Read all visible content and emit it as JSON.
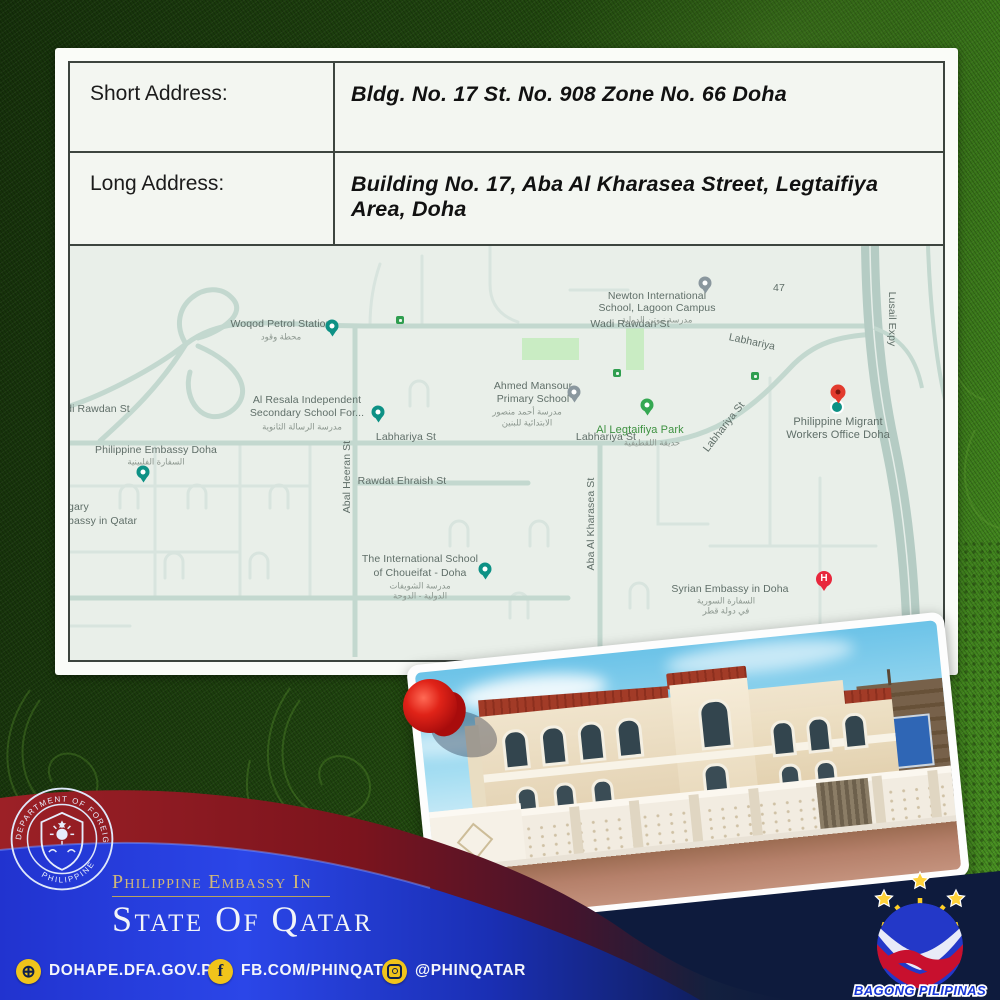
{
  "address_card": {
    "rows": [
      {
        "label": "Short Address:",
        "value": "Bldg. No. 17 St. No. 908 Zone No. 66 Doha"
      },
      {
        "label": "Long Address:",
        "value": "Building No. 17, Aba Al Kharasea Street, Legtaifiya Area, Doha"
      }
    ]
  },
  "map": {
    "h_pin_label": "H",
    "labels": [
      {
        "text": "Woqod Petrol Station"
      },
      {
        "text": "محطة وقود"
      },
      {
        "text": "Wadi Rawdan St"
      },
      {
        "text": "Newton International"
      },
      {
        "text": "School, Lagoon Campus"
      },
      {
        "text": "مدرسة نيوتن الدولية"
      },
      {
        "text": "47"
      },
      {
        "text": "Labhariya"
      },
      {
        "text": "Lusail Expy"
      },
      {
        "text": "di Rawdan St"
      },
      {
        "text": "Al Resala Independent"
      },
      {
        "text": "Secondary School For..."
      },
      {
        "text": "مدرسة الرسالة الثانوية"
      },
      {
        "text": "Ahmed Mansour"
      },
      {
        "text": "Primary School"
      },
      {
        "text": "مدرسة أحمد منصور"
      },
      {
        "text": "الابتدائية للبنين"
      },
      {
        "text": "Al Legtaifiya Park"
      },
      {
        "text": "حديقة اللقطيفية"
      },
      {
        "text": "Labhariya St"
      },
      {
        "text": "Labhariya St"
      },
      {
        "text": "Labhariya St"
      },
      {
        "text": "Philippine Embassy Doha"
      },
      {
        "text": "السفارة الفلبينية"
      },
      {
        "text": "gary"
      },
      {
        "text": "bassy in Qatar"
      },
      {
        "text": "Abal Heeran St"
      },
      {
        "text": "Rawdat Ehraish St"
      },
      {
        "text": "The International School"
      },
      {
        "text": "of Choueifat - Doha"
      },
      {
        "text": "مدرسة الشويفات"
      },
      {
        "text": "الدولية - الدوحة"
      },
      {
        "text": "Aba Al Kharasea St"
      },
      {
        "text": "Syrian Embassy in Doha"
      },
      {
        "text": "السفارة السورية"
      },
      {
        "text": "في دولة قطر"
      },
      {
        "text": "Philippine Migrant"
      },
      {
        "text": "Workers Office Doha"
      }
    ]
  },
  "footer": {
    "embassy_line1": "Philippine Embassy In",
    "embassy_line2": "State Of Qatar",
    "website": "DOHAPE.DFA.GOV.PH",
    "facebook": "FB.COM/PHINQATAR",
    "instagram": "@PHINQATAR",
    "facebook_glyph": "f",
    "globe_glyph": "⊕",
    "bagong_label": "BAGONG PILIPINAS",
    "seal_ring_top": "DEPARTMENT OF FOREIGN AFFAIRS",
    "seal_ring_bottom": "PHILIPPINES"
  },
  "colors": {
    "background_green": "#1e420e",
    "bright_green": "#4a9422",
    "maroon_band": "#8e1a22",
    "royal_blue_band": "#1c2fd4",
    "navy": "#0e1b3d",
    "gold_text": "#cfb77a",
    "icon_yellow": "#f0c41b",
    "map_background": "#e9efe9",
    "map_road": "#c3d8cf",
    "map_teal_pin": "#0d9185",
    "map_red_pin": "#e23b2e",
    "park_green": "#c9ecc3"
  }
}
